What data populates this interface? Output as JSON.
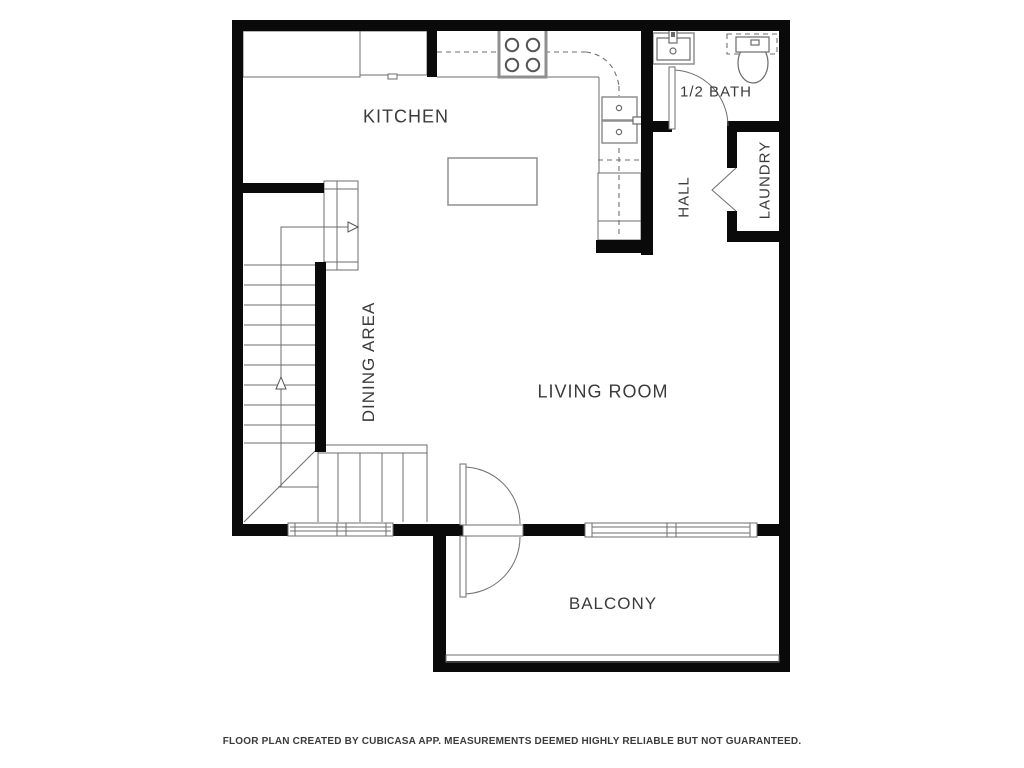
{
  "title": "Floor plan",
  "colors": {
    "wall": "#0a0a0a",
    "line": "#6e6e6e",
    "fixture": "#8f8f8f",
    "text": "#3b3b3b",
    "bg": "#ffffff"
  },
  "rooms": {
    "kitchen": {
      "label": "KITCHEN",
      "orientation": "horizontal"
    },
    "half_bath": {
      "label": "1/2 BATH",
      "orientation": "horizontal"
    },
    "hall": {
      "label": "HALL",
      "orientation": "vertical"
    },
    "laundry": {
      "label": "LAUNDRY",
      "orientation": "vertical"
    },
    "dining": {
      "label": "DINING AREA",
      "orientation": "vertical"
    },
    "living": {
      "label": "LIVING ROOM",
      "orientation": "horizontal"
    },
    "balcony": {
      "label": "BALCONY",
      "orientation": "horizontal"
    }
  },
  "fixtures": [
    "stove-icon",
    "kitchen-sink-icon",
    "kitchen-island",
    "dishwasher-icon",
    "bath-sink-icon",
    "toilet-icon",
    "staircase-icon",
    "walkline-arrow-icon",
    "swing-door-icon",
    "bifold-door-icon",
    "balcony-double-door-icon",
    "window",
    "balcony-railing"
  ],
  "footer": {
    "disclaimer": "FLOOR PLAN CREATED BY CUBICASA APP. MEASUREMENTS DEEMED HIGHLY RELIABLE BUT NOT GUARANTEED."
  }
}
